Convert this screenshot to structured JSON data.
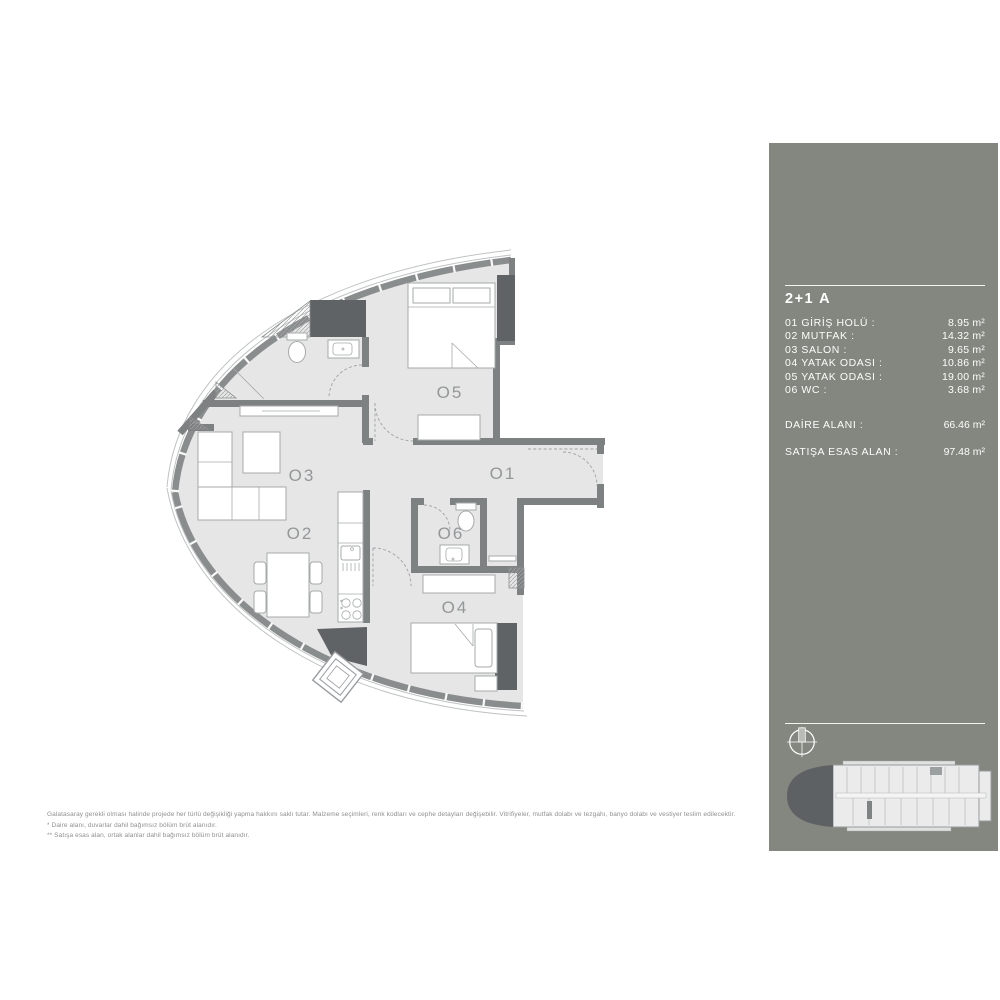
{
  "colors": {
    "panel": "#84877f",
    "wall": "#7e8182",
    "shaft": "#5f6366",
    "floor": "#e6e6e7",
    "band": "#8a8d8d",
    "label": "#949798",
    "footer": "#8f9092"
  },
  "panel": {
    "title": "2+1 A",
    "rooms": [
      {
        "plan_label": "O1",
        "label": "01 GİRİŞ HOLÜ :",
        "area": "8.95 m²"
      },
      {
        "plan_label": "O2",
        "label": "02 MUTFAK :",
        "area": "14.32 m²"
      },
      {
        "plan_label": "O3",
        "label": "03 SALON :",
        "area": "9.65 m²"
      },
      {
        "plan_label": "O4",
        "label": "04 YATAK ODASI :",
        "area": "10.86 m²"
      },
      {
        "plan_label": "O5",
        "label": "05 YATAK ODASI :",
        "area": "19.00 m²"
      },
      {
        "plan_label": "O6",
        "label": "06 WC :",
        "area": "3.68 m²"
      }
    ],
    "totals": [
      {
        "label": "DAİRE ALANI :",
        "value": "66.46 m²"
      },
      {
        "label": "SATIŞA ESAS ALAN :",
        "value": "97.48 m²"
      }
    ]
  },
  "footer": {
    "line1": "Galatasaray gerekli olması halinde projede her türlü değişikliği yapma hakkını saklı tutar. Malzeme seçimleri, renk kodları ve cephe detayları değişebilir. Vitrifiyeler, mutfak dolabı ve tezgahı, banyo dolabı ve vestiyer teslim edilecektir.",
    "line2": "* Daire alanı, duvarlar dahil bağımsız bölüm brüt alanıdır.",
    "line3": "** Satışa esas alan, ortak alanlar dahil bağımsız bölüm brüt alanıdır."
  },
  "icons": {
    "compass": "compass-north-icon",
    "key_plan": "building-key-plan"
  }
}
